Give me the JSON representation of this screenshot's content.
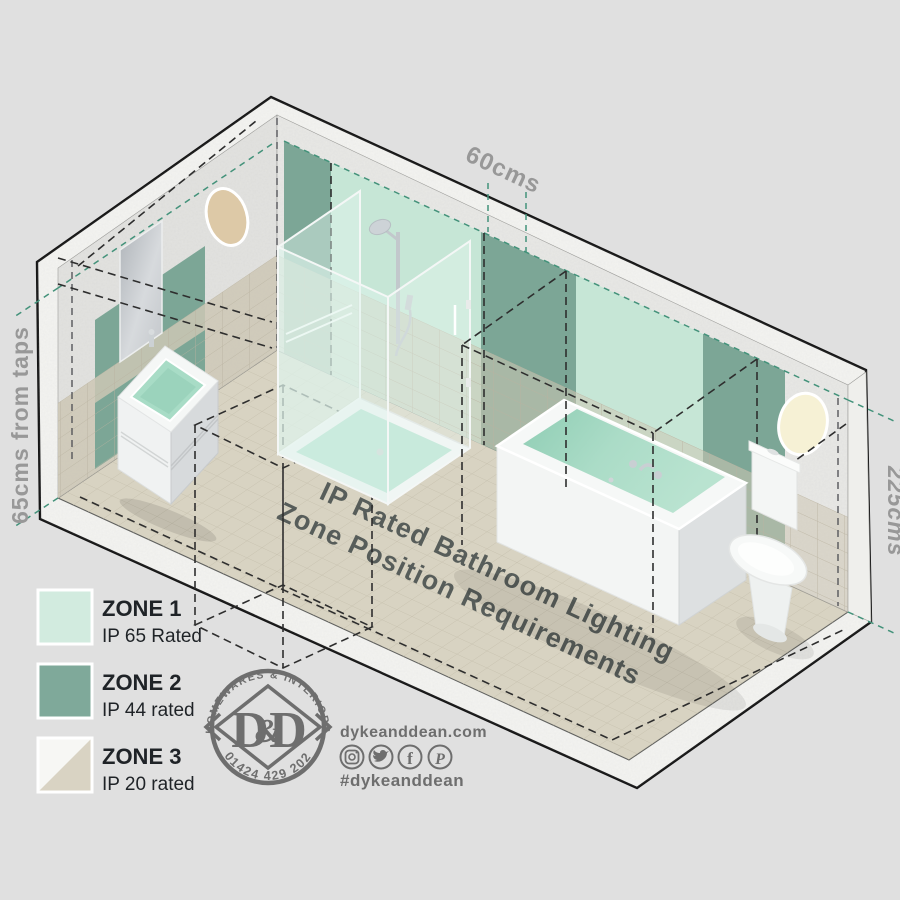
{
  "poster": {
    "title_line1": "IP Rated Bathroom Lighting",
    "title_line2": "Zone Position Requirements"
  },
  "dimensions": {
    "shower_width": "60cms",
    "taps_distance": "65cms from taps",
    "zone_height": "225cms"
  },
  "legend": {
    "items": [
      {
        "label": "ZONE 1",
        "rating": "IP 65 Rated",
        "color": "#d2ebdf"
      },
      {
        "label": "ZONE 2",
        "rating": "IP 44 rated",
        "color": "#7fa99a"
      },
      {
        "label": "ZONE 3",
        "rating": "IP 20 rated",
        "color": "#f7f7f4",
        "color_secondary": "#d9d3c3"
      }
    ]
  },
  "brand": {
    "badge_top": "HOMEWARES & INTERIORS",
    "badge_phone": "01424 429 202",
    "monogram_left": "D",
    "monogram_amp": "&",
    "monogram_right": "D",
    "website": "dykeanddean.com",
    "hashtag": "#dykeanddean",
    "social_icons": [
      "instagram",
      "twitter",
      "facebook",
      "pinterest"
    ]
  },
  "colors": {
    "background": "#e0e0e0",
    "zone1_panel": "#c6e6d6",
    "zone2_panel": "#7ca696",
    "floor": "#d8d3c2",
    "wall_tile": "#cdc7b5",
    "guide_teal": "#43927a"
  }
}
